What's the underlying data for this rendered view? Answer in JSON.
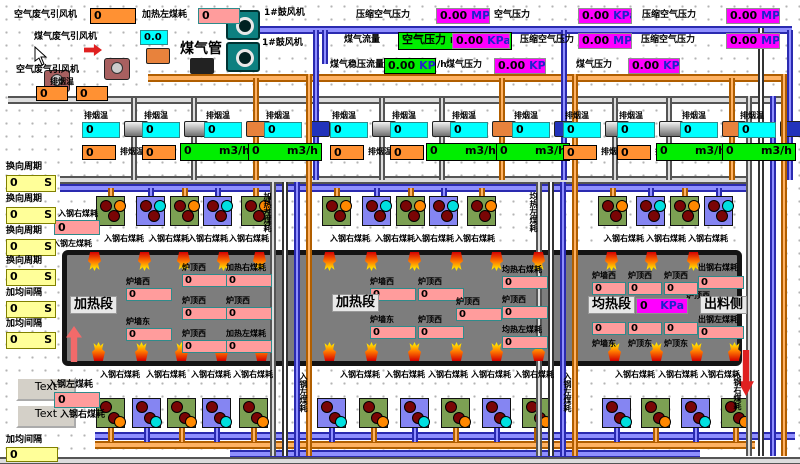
{
  "topLeft": {
    "airFanLabel": "空气废气引风机",
    "airFanValue": "0",
    "heatLeftLabel": "加热左煤耗",
    "heatLeftValue": "0",
    "gasFanLabel": "煤气废气引风机",
    "smokeTempValue": "0.0",
    "gasPipeLabel": "煤气管",
    "airFan2Label": "空气废气引风机",
    "smokeTempLabel": "排烟温",
    "fanValue1": "0",
    "fanValue2": "0",
    "blower1": "1#鼓风机",
    "blower2": "1#鼓风机"
  },
  "pressures": [
    {
      "label": "压缩空气压力",
      "value": "0.00",
      "unit": "MPa"
    },
    {
      "label": "空气压力",
      "value": "0.00",
      "unit": "KPa"
    },
    {
      "label": "压缩空气压力",
      "value": "0.00",
      "unit": "MPa"
    },
    {
      "label": "煤气流量",
      "boxText": "空气压力 m3/",
      "value": "0.00",
      "unit": "KPa"
    },
    {
      "label": "压缩空气压力",
      "value": "0.00",
      "unit": "MPa"
    },
    {
      "label": "压缩空气压力",
      "value": "0.00",
      "unit": "MPa"
    },
    {
      "label": "煤气稳压流量",
      "greenValue": "0.00",
      "greenUnit": "KPa",
      "suffix": "/h"
    },
    {
      "label": "煤气压力",
      "value": "0.00",
      "unit": "KPa"
    },
    {
      "label": "煤气压力",
      "value": "0.00",
      "unit": "KPa"
    }
  ],
  "smoke": {
    "label": "排烟温",
    "tempValue": "0",
    "auxValue": "0",
    "flowValue": "0",
    "flowUnit": "m3/h"
  },
  "leftPanel": {
    "items": [
      {
        "label": "换向周期",
        "value": "0",
        "unit": "S"
      },
      {
        "label": "换向周期",
        "value": "0",
        "unit": "S"
      },
      {
        "label": "换向周期",
        "value": "0",
        "unit": "S"
      },
      {
        "label": "换向周期",
        "value": "0",
        "unit": "S"
      },
      {
        "label": "加均间隔",
        "value": "0",
        "unit": "S"
      },
      {
        "label": "加均间隔",
        "value": "0",
        "unit": "S"
      }
    ]
  },
  "entrySide": {
    "topLabel": "入钢右煤耗",
    "topValue": "0",
    "bottomLabel": "入钢左煤耗",
    "lowerLabel1": "入钢左煤耗",
    "lowerValue": "0",
    "lowerLabel2": "入钢右煤耗"
  },
  "bottomLeft": {
    "button1": "Text",
    "button2": "Text",
    "intervalLabel": "加均间隔",
    "intervalValue": "0"
  },
  "furnace": {
    "tag1": "加热段",
    "tag2": "加热段",
    "tag3": "均热段",
    "tag4": "出料侧",
    "pressureValue": "0",
    "pressureUnit": "KPa",
    "midLabel": "炉顶西",
    "boxes": [
      {
        "label": "炉墙西",
        "value": "0"
      },
      {
        "label": "炉墙东",
        "value": "0"
      },
      {
        "label": "炉顶西",
        "value": "0"
      },
      {
        "label": "炉顶西",
        "value": "0"
      },
      {
        "label": "炉顶西",
        "value": "0"
      },
      {
        "label": "加热右煤耗",
        "value": "0"
      },
      {
        "label": "炉顶西",
        "value": "0"
      },
      {
        "label": "加热左煤耗",
        "value": "0"
      },
      {
        "label": "炉墙西",
        "value": "0"
      },
      {
        "label": "炉墙东",
        "value": "0"
      },
      {
        "label": "炉顶西",
        "value": "0"
      },
      {
        "label": "炉顶西",
        "value": "0"
      },
      {
        "label": "炉顶西",
        "value": "0"
      },
      {
        "label": "均热右煤耗",
        "value": "0"
      },
      {
        "label": "炉顶西",
        "value": "0"
      },
      {
        "label": "均热左煤耗",
        "value": "0"
      },
      {
        "label": "炉墙西",
        "value": "0"
      },
      {
        "label": "炉顶西",
        "value": "0"
      },
      {
        "label": "炉顶西",
        "value": "0"
      },
      {
        "label": "出钢右煤耗",
        "value": "0"
      },
      {
        "label": "炉墙东",
        "value": "0"
      },
      {
        "label": "炉顶东",
        "value": "0"
      },
      {
        "label": "炉顶东",
        "value": "0"
      },
      {
        "label": "出钢左煤耗",
        "value": "0"
      }
    ]
  },
  "burnerLabel": "入钢右煤耗",
  "verticalLabels": [
    "加热左煤耗",
    "均热左煤耗",
    "入钢左煤耗",
    "入钢左煤耗",
    "入钢右煤耗"
  ],
  "colors": {
    "accentMagenta": "#ff00ff",
    "accentGreen": "#00ee00",
    "furnaceGray": "#7d7d7d"
  }
}
